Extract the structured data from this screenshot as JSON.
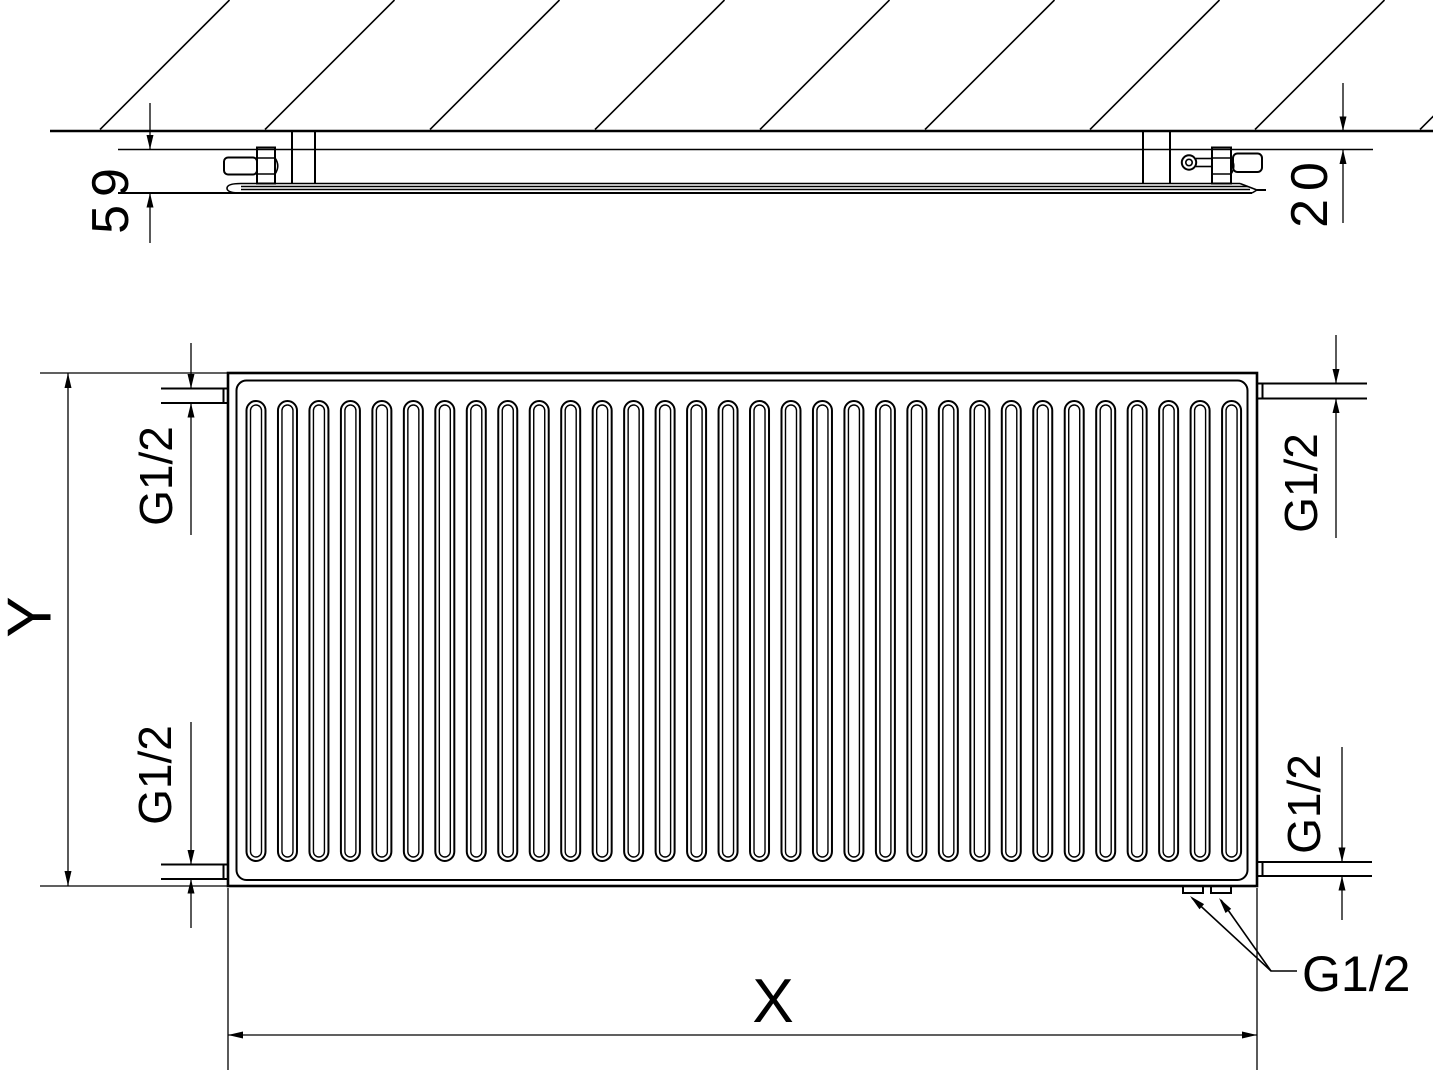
{
  "drawing": {
    "title": "panel-radiator-dimensional-drawing",
    "labels": {
      "depth": "59",
      "wall_distance": "20",
      "height": "Y",
      "width": "X",
      "thread_top_left": "G1/2",
      "thread_bottom_left": "G1/2",
      "thread_top_right": "G1/2",
      "thread_bottom_right": "G1/2",
      "thread_bottom_connections": "G1/2"
    },
    "top_view": {
      "hatch_line_count": 9
    },
    "front_view": {
      "slot_count": 32
    },
    "colors": {
      "line": "#000000",
      "background": "#ffffff"
    }
  }
}
